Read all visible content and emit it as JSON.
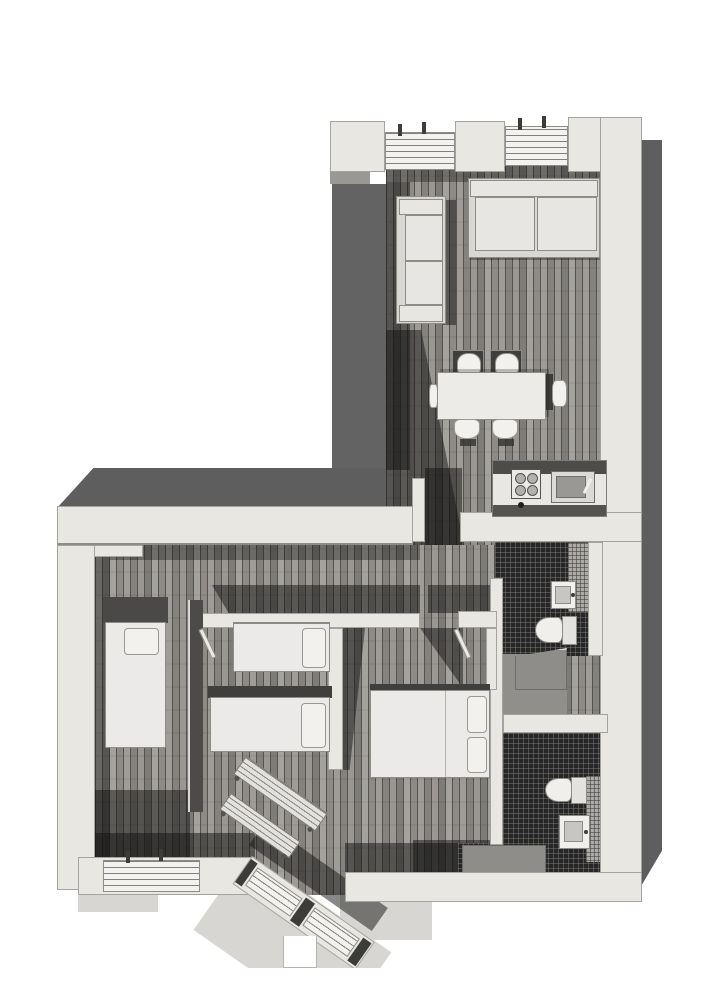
{
  "figure": {
    "kind": "grayscale axonometric cutaway floor plan rendering of an apartment",
    "orientation": "L-shaped plan, living wing top-right, bedroom wing bottom",
    "text_labels": [],
    "interactive": false
  },
  "palette": {
    "paper": "#ffffff",
    "wall": "#e9e7e2",
    "wall_edge": "#a5a39e",
    "shadow_face": "#5e5e5e",
    "interior_shadow": "rgba(18,18,18,0.5)",
    "wood_base": "#9a9792",
    "wood_seam": "#55524d",
    "tile_dark": "#262626",
    "mosaic": "#adaba7",
    "apron": "#d7d6d2",
    "furniture": "#e8e6e2",
    "pillow": "#f2f1ee",
    "dark_accent": "#3c3c3a"
  },
  "rooms": [
    {
      "id": "living-dining-room",
      "floor": "wood-planks",
      "contents": [
        "small-sofa",
        "large-sofa",
        "dining-table",
        "six-dining-chairs",
        "kitchen-counter-with-stove-and-sink",
        "two-north-windows"
      ]
    },
    {
      "id": "bedroom-single",
      "floor": "wood-planks",
      "contents": [
        "single-bed",
        "south-window",
        "wall-shelf"
      ]
    },
    {
      "id": "bedroom-twin",
      "floor": "wood-planks",
      "contents": [
        "twin-bed-a",
        "twin-bed-b",
        "door"
      ]
    },
    {
      "id": "bedroom-master",
      "floor": "wood-planks",
      "contents": [
        "double-bed",
        "door"
      ]
    },
    {
      "id": "bathroom-north",
      "floor": "dark-mosaic-tile",
      "contents": [
        "wash-basin",
        "toilet",
        "shower"
      ]
    },
    {
      "id": "bathroom-south",
      "floor": "dark-mosaic-tile",
      "contents": [
        "wash-basin",
        "toilet",
        "shower-tray"
      ]
    },
    {
      "id": "utility-room",
      "floor": "screed",
      "contents": []
    },
    {
      "id": "hallway",
      "floor": "wood-planks",
      "contents": [
        "chamfered-corner-windows",
        "two-diagonal-radiators"
      ]
    }
  ]
}
